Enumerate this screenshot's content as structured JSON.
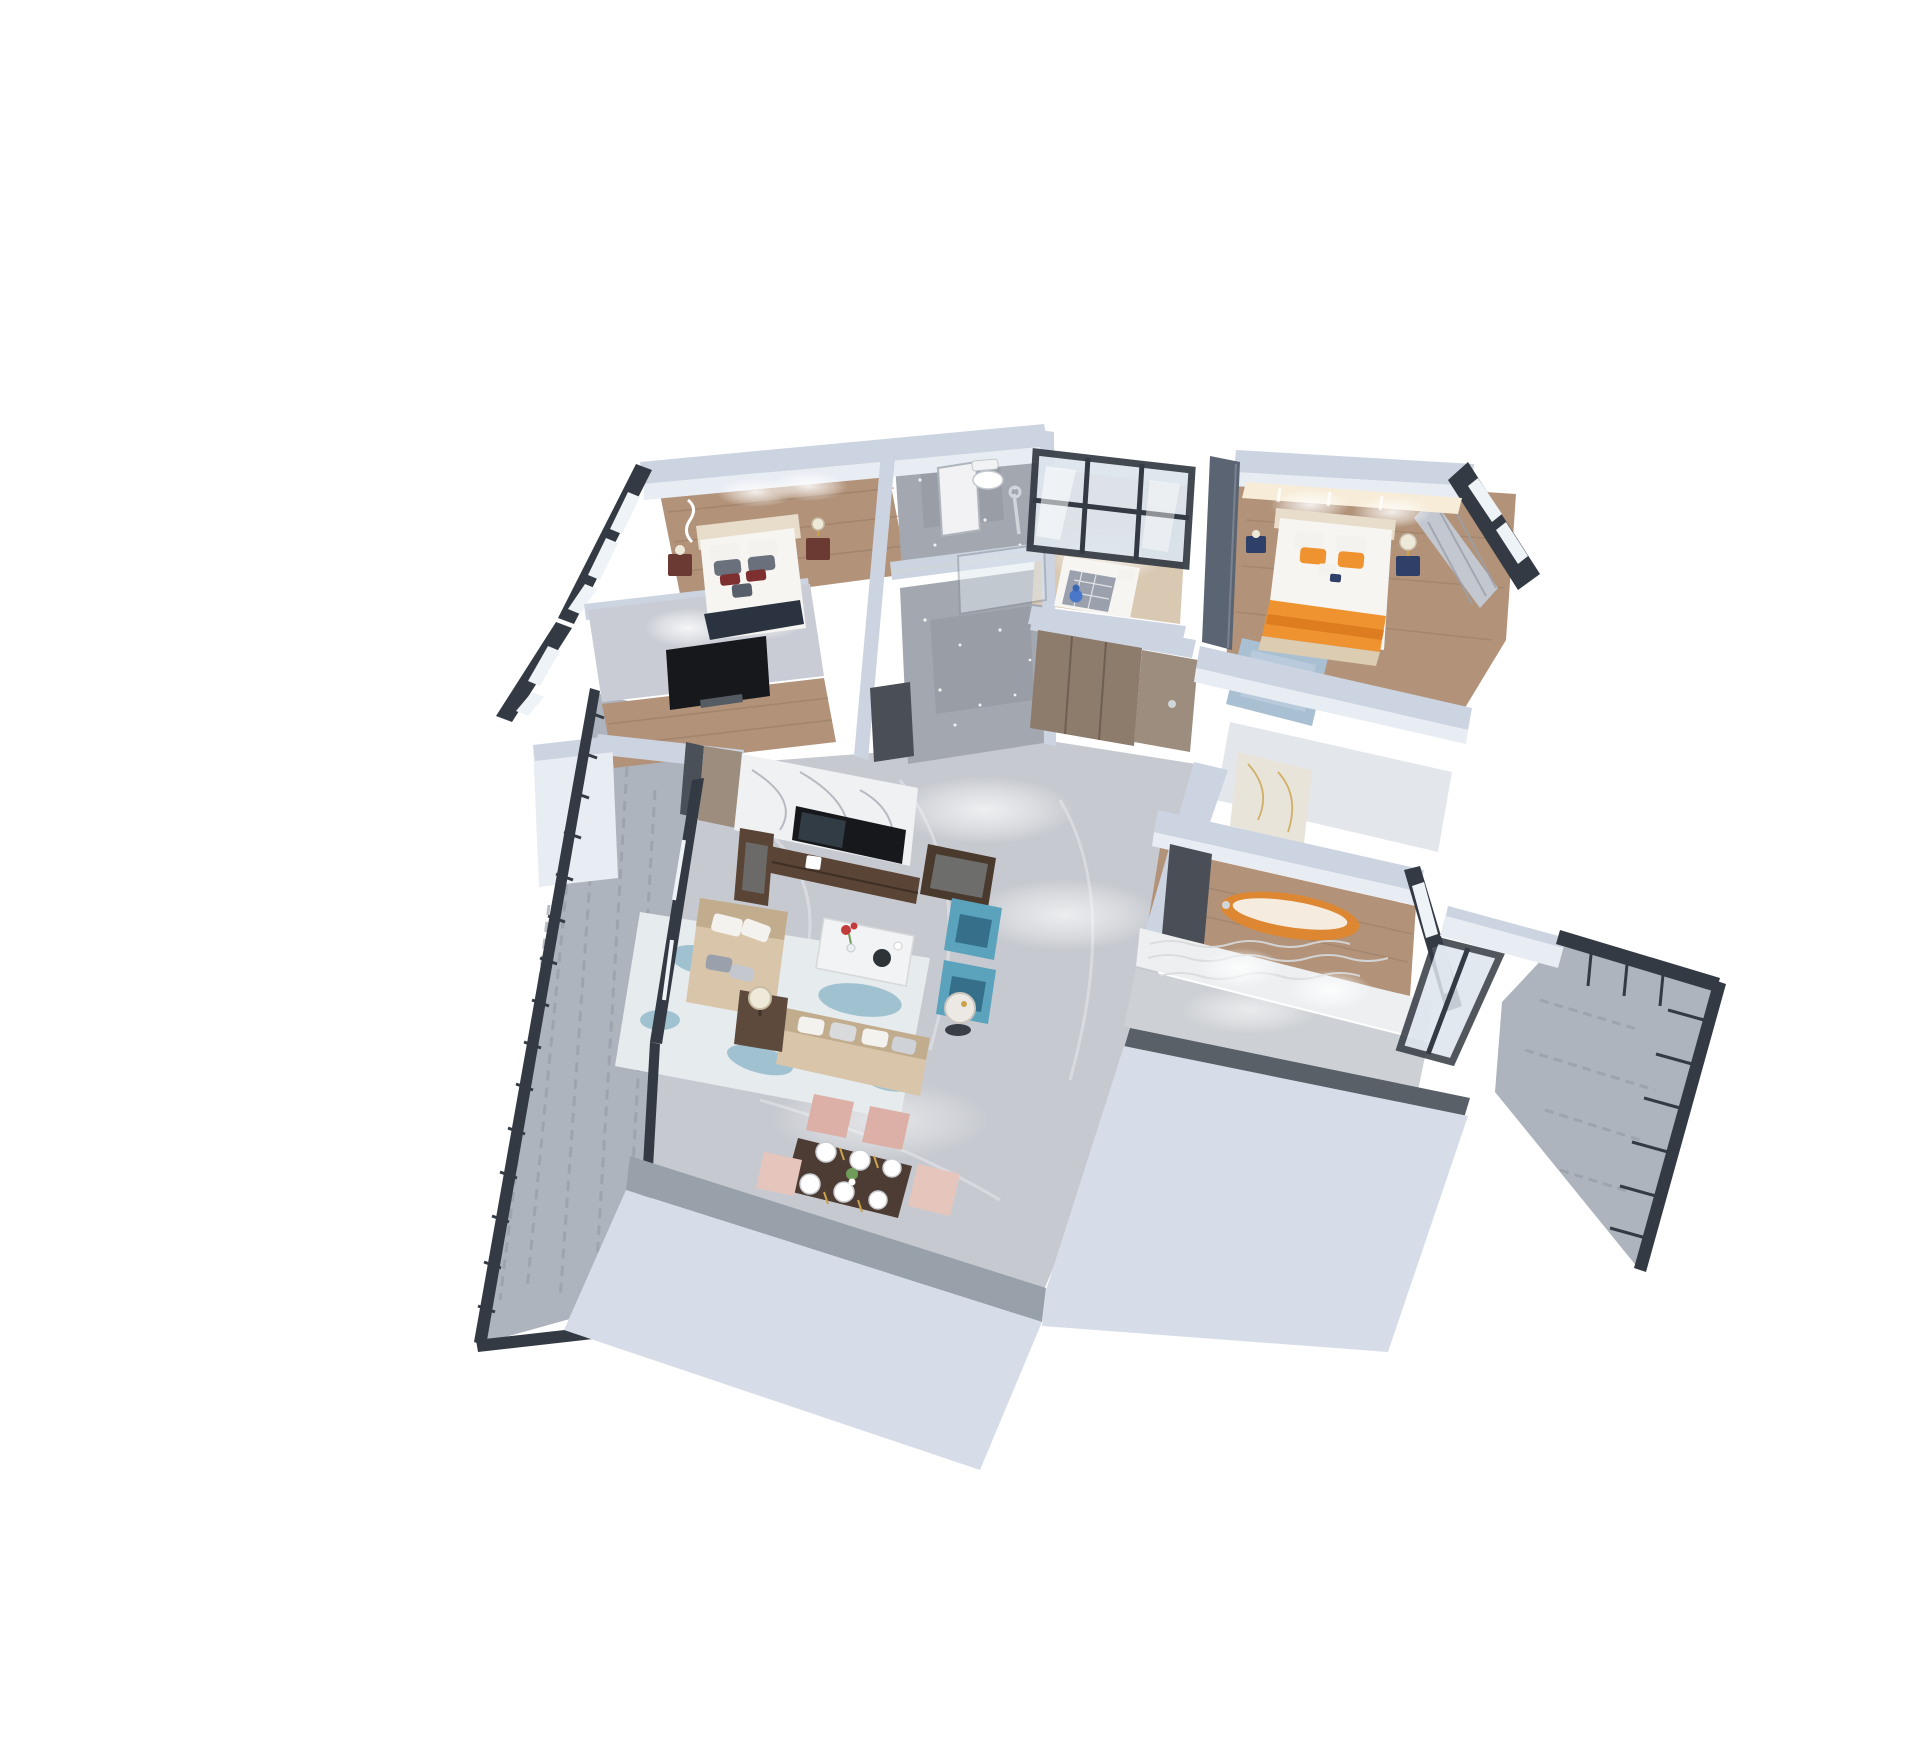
{
  "scene": {
    "title": "3D isometric cutaway floor plan rendering of a modern three-bedroom apartment on a white background",
    "view": "bird's-eye dollhouse view, walls cut at waist height",
    "width_px": 1920,
    "height_px": 1754
  },
  "palette": {
    "pageBg": "#ffffff",
    "wallTop": "#ccd4e1",
    "wallFace": "#e8ecf3",
    "wallShade": "#aab3c2",
    "darkFrame": "#343a43",
    "paneLight": "#eef3f7",
    "paneSky": "#dde5ed",
    "woodFloor": "#b2937a",
    "woodDark": "#93765f",
    "marbleFloor": "#c6c9cf",
    "marbleLight": "#dcdee2",
    "bathTile": "#a3a8b0",
    "bathTileDark": "#8d929b",
    "balconyTile": "#aeb4bd",
    "balconyTileDark": "#959ca6",
    "marbleWallWhite": "#eff1f3",
    "veinGray": "#9fa4ab",
    "sofaBeige": "#d8c5aa",
    "sofaBeigeDark": "#c2ac8e",
    "pillowWhite": "#f4f2ee",
    "pillowGray": "#9aa0ac",
    "maroon": "#7e2f2f",
    "chairBlue": "#5ba3bd",
    "chairBlueDark": "#356f8a",
    "rugBase": "#e6ebee",
    "rugBlue": "#8fb9c9",
    "tableWhite": "#f2f3f4",
    "consoleWood": "#5a4435",
    "tvBlack": "#16181c",
    "diningWood": "#4d3c33",
    "chairPink": "#dcb0a6",
    "chairPinkLight": "#e6c6bc",
    "gold": "#c9a24b",
    "bedWhite": "#f6f5f2",
    "headboardCream": "#e7ddca",
    "orange": "#ef9330",
    "orangeDeep": "#d9791c",
    "rugMaster": "#a9bfd2",
    "navy": "#2e4067",
    "glowWarm": "#f7ecd8",
    "tubCopper": "#dd8733",
    "tubInner": "#f5ecdf",
    "matDark": "#4a4f57",
    "doorTaupe": "#9d8d7e",
    "closetWood": "#8d7b6c",
    "chrome": "#cfd6da",
    "flowerRed": "#c23b3b",
    "plantGreen": "#6f9c5a",
    "grayBand": "#98a0aa",
    "outerWallPale": "#d7dde8",
    "texturedWall": "#edeff1",
    "wallLit": "#c9ccd4",
    "navyThrow": "#2b3340",
    "lampShade": "#efe9da"
  },
  "rooms": [
    {
      "id": "bedroom-1",
      "label": "Bedroom with double bed, maroon accent pillows and media wall",
      "floor": "wood"
    },
    {
      "id": "media-room",
      "label": "TV lounge with wall-mounted television",
      "floor": "wood"
    },
    {
      "id": "bathroom",
      "label": "Bathroom with toilet, shower and glass partition",
      "floor": "gray stone tile"
    },
    {
      "id": "kids-room",
      "label": "Small bedroom behind black-framed glass partition",
      "floor": "light wood"
    },
    {
      "id": "master-bedroom",
      "label": "Master bedroom with orange accent bedding and backlit headboard",
      "floor": "wood"
    },
    {
      "id": "hallway-living",
      "label": "Entry hall, living room and dining area with gray marble floor",
      "floor": "gray marble"
    },
    {
      "id": "closet",
      "label": "Built-in wardrobe closet at entry hall",
      "floor": ""
    },
    {
      "id": "ensuite",
      "label": "Ensuite passage with gold-veined marble wall",
      "floor": "pale tile"
    },
    {
      "id": "tub-room",
      "label": "Bathroom with freestanding copper bathtub",
      "floor": "wood"
    },
    {
      "id": "kitchen-annex",
      "label": "Kitchen corridor with textured feature wall",
      "floor": "marble"
    },
    {
      "id": "balcony-left",
      "label": "Large balcony with dark metal railing",
      "floor": "gray outdoor carpet tile"
    },
    {
      "id": "balcony-right",
      "label": "Small balcony with dark metal railing",
      "floor": "gray outdoor tile"
    }
  ],
  "furniture": [
    "double bed with white linens",
    "maroon nightstands with lamps",
    "decorative wall light sculpture",
    "wall-mounted TV",
    "toilet",
    "chrome shower set",
    "glass shower screen",
    "white door panel",
    "single bed with plaid blanket",
    "blue toy figurine",
    "taupe wardrobe doors",
    "master bed with orange pillows and throw",
    "navy bedside cabinets",
    "blue area rug",
    "gray curtain",
    "white marble TV feature wall",
    "walnut TV console with television",
    "display cabinets",
    "beige chaise sofa",
    "beige three-seat sofa",
    "white coffee table with red flowers",
    "two blue wingback armchairs",
    "round side table",
    "table lamp",
    "blue-splash area rug",
    "dark wood dining table with six white place settings and gold cutlery",
    "pink dining chairs",
    "copper freestanding bathtub",
    "dark floor mat"
  ]
}
